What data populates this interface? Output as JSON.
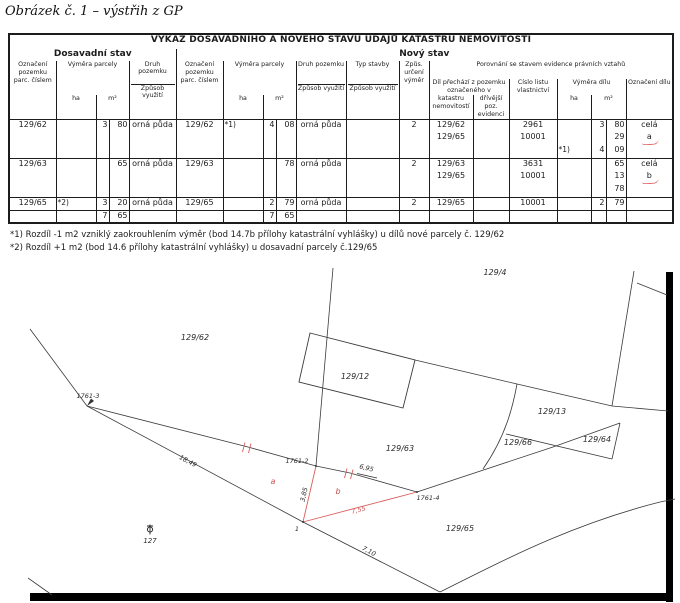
{
  "caption": "Obrázek č. 1 – výstřih z GP",
  "table": {
    "title": "VÝKAZ DOSAVADNÍHO A NOVÉHO STAVU ÚDAJŮ KATASTRU NEMOVITOSTÍ",
    "sections": {
      "old": "Dosavadní stav",
      "new": "Nový stav"
    },
    "headers": {
      "parcel": "Označení pozemku parc. číslem",
      "area": "Výměra parcely",
      "ha": "ha",
      "m2": "m²",
      "land_type": "Druh pozemku",
      "usage": "Způsob využití",
      "building_type": "Typ stavby",
      "det": "Způs. určení výměr",
      "compare": "Porovnání se stavem evidence právních vztahů",
      "dil_from": "Díl přechází z pozemku označeného v",
      "kat": "katastru nemovitostí",
      "driv": "dřívější poz. evidenci",
      "lv": "Číslo listu vlastnictví",
      "dil_area": "Výměra dílu",
      "dil_ozn": "Označení dílu"
    },
    "blocks": [
      {
        "old_parc": "129/62",
        "old_note": "",
        "old_m2a": "3",
        "old_m2b": "80",
        "old_druh": "orná půda",
        "new_parc": "129/62",
        "new_note": "*1)",
        "new_m2a": "4",
        "new_m2b": "08",
        "new_druh": "orná půda",
        "typ": "",
        "zpus": "2",
        "dily": [
          {
            "kat": "129/62",
            "driv": "",
            "lv": "2961",
            "note": "",
            "m2a": "3",
            "m2b": "80",
            "ozn": "celá"
          },
          {
            "kat": "129/65",
            "driv": "",
            "lv": "10001",
            "note": "",
            "m2a": "",
            "m2b": "29",
            "ozn": "a"
          },
          {
            "kat": "",
            "driv": "",
            "lv": "",
            "note": "*1)",
            "m2a": "4",
            "m2b": "09",
            "ozn": ""
          }
        ]
      },
      {
        "old_parc": "129/63",
        "old_note": "",
        "old_m2a": "",
        "old_m2b": "65",
        "old_druh": "orná půda",
        "new_parc": "129/63",
        "new_note": "",
        "new_m2a": "",
        "new_m2b": "78",
        "new_druh": "orná půda",
        "typ": "",
        "zpus": "2",
        "dily": [
          {
            "kat": "129/63",
            "driv": "",
            "lv": "3631",
            "note": "",
            "m2a": "",
            "m2b": "65",
            "ozn": "celá"
          },
          {
            "kat": "129/65",
            "driv": "",
            "lv": "10001",
            "note": "",
            "m2a": "",
            "m2b": "13",
            "ozn": "b"
          },
          {
            "kat": "",
            "driv": "",
            "lv": "",
            "note": "",
            "m2a": "",
            "m2b": "78",
            "ozn": ""
          }
        ]
      },
      {
        "old_parc": "129/65",
        "old_note": "*2)",
        "old_m2a": "3",
        "old_m2b": "20",
        "old_druh": "orná půda",
        "new_parc": "129/65",
        "new_note": "",
        "new_m2a": "2",
        "new_m2b": "79",
        "new_druh": "orná půda",
        "typ": "",
        "zpus": "2",
        "dily": [
          {
            "kat": "129/65",
            "driv": "",
            "lv": "10001",
            "note": "",
            "m2a": "2",
            "m2b": "79",
            "ozn": ""
          }
        ]
      }
    ],
    "totals": {
      "old_m2a": "7",
      "old_m2b": "65",
      "new_m2a": "7",
      "new_m2b": "65"
    },
    "footnotes": [
      "*1) Rozdíl -1 m2 vzniklý zaokrouhlením výměr (bod 14.7b přílohy katastrální vyhlášky) u dílů nové parcely č. 129/62",
      "*2) Rozdíl +1 m2 (bod 14.6 přílohy katastrální vyhlášky) u dosavadní parcely č.129/65"
    ]
  },
  "map": {
    "parcels": {
      "p129_4": "129/4",
      "p129_62": "129/62",
      "p129_12": "129/12",
      "p129_13": "129/13",
      "p129_66": "129/66",
      "p129_64": "129/64",
      "p129_63": "129/63",
      "p129_65": "129/65"
    },
    "points": {
      "pt1761_3": "1761-3",
      "pt1761_2": "1761-2",
      "pt1761_4": "1761-4",
      "pt1": "1",
      "pt127": "127"
    },
    "measurements": {
      "m18_49": "18,49",
      "m6_95": "6,95",
      "m3_85": "3,85",
      "m7_55": "7,55",
      "m7_10": "7,10"
    },
    "red_marks": {
      "letter_a": "a",
      "letter_b": "b"
    },
    "colors": {
      "red": "#d95c5c",
      "line": "#3a3a3a"
    }
  }
}
